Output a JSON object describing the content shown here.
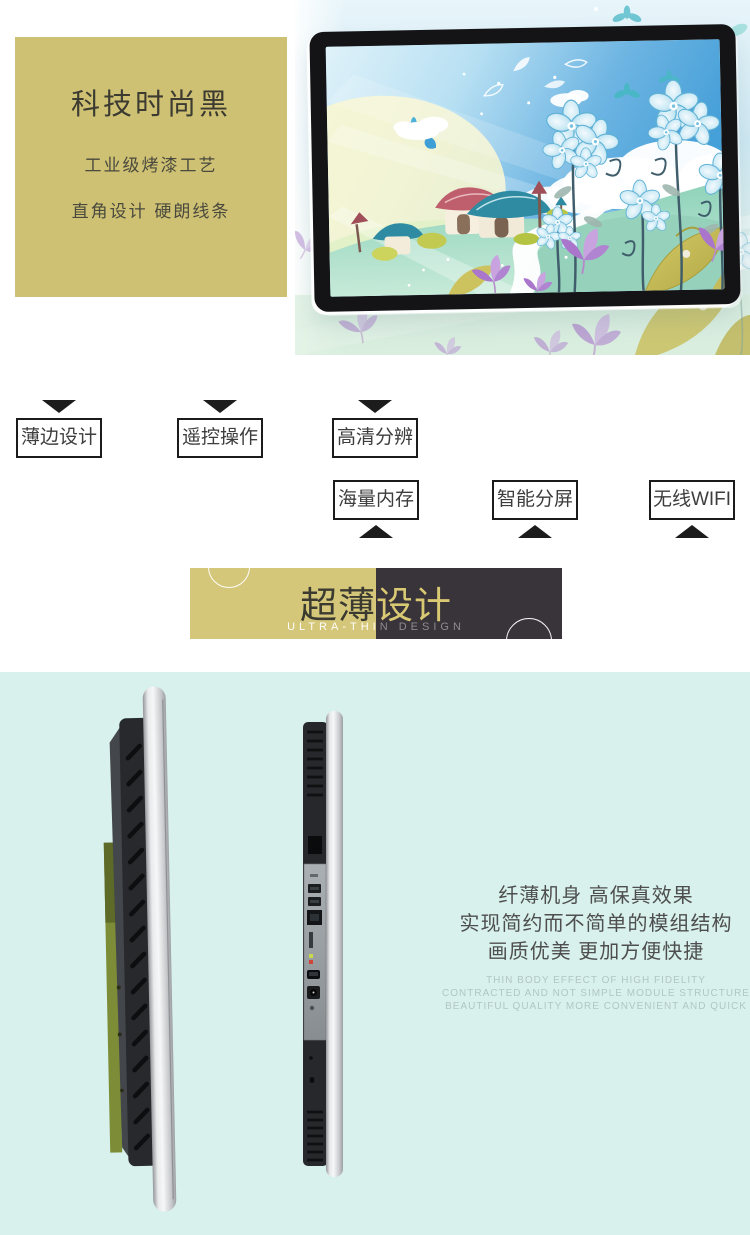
{
  "hero": {
    "panel": {
      "title": "科技时尚黑",
      "subtitle1": "工业级烤漆工艺",
      "subtitle2": "直角设计 硬朗线条"
    }
  },
  "features": {
    "row1": [
      "薄边设计",
      "遥控操作",
      "高清分辨"
    ],
    "row2": [
      "海量内存",
      "智能分屏",
      "无线WIFI"
    ]
  },
  "banner": {
    "title": "超薄设计",
    "subtitle": "ULTRA-THIN DESIGN"
  },
  "showcase": {
    "cn_lines": [
      "纤薄机身 高保真效果",
      "实现简约而不简单的模组结构",
      "画质优美 更加方便快捷"
    ],
    "en_lines": [
      "THIN BODY EFFECT OF HIGH FIDELITY",
      "CONTRACTED AND NOT SIMPLE MODULE STRUCTURE",
      "BEAUTIFUL QUALITY MORE CONVENIENT AND QUICK"
    ]
  },
  "colors": {
    "panel_gold": "#cfc173",
    "banner_gold": "#d5c77a",
    "banner_dark": "#39333a",
    "showcase_bg": "#d8f1ec",
    "feature_border": "#1b1b1b"
  }
}
